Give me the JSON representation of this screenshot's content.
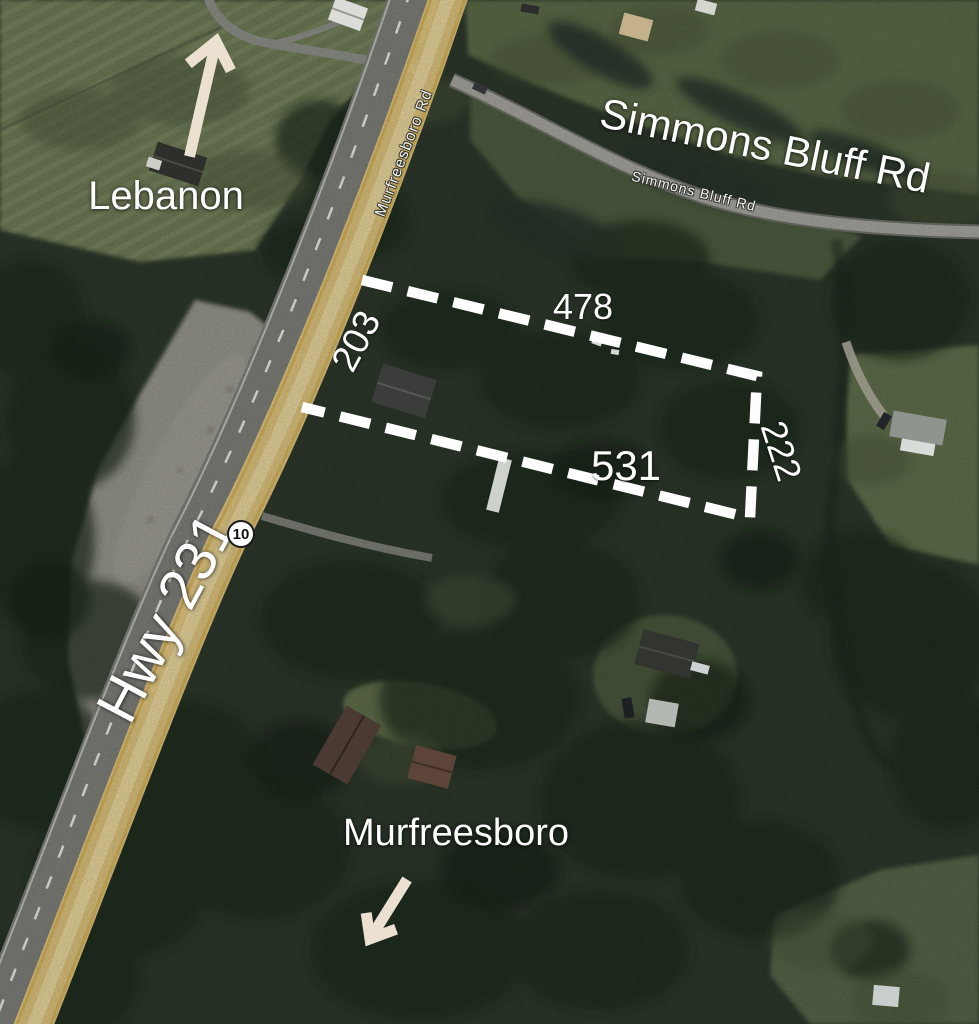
{
  "map": {
    "destinations": {
      "north_label": "Lebanon",
      "south_label": "Murfreesboro"
    },
    "roads": {
      "highway_label": "Hwy 231",
      "route_shield_number": "10",
      "murfreesboro_rd_street_label": "Murfreesboro Rd",
      "simmons_bluff_label_large": "Simmons Bluff Rd",
      "simmons_bluff_street_label": "Simmons Bluff Rd"
    },
    "parcel": {
      "side_top": "478",
      "side_left": "203",
      "side_bottom": "531",
      "side_right": "222"
    },
    "colors": {
      "highway_highlight_yellow": "#e7cb82",
      "parcel_outline": "#ffffff",
      "direction_arrow": "#ece1d1",
      "label_text": "#ffffff",
      "forest_base": "#2c372a"
    }
  }
}
